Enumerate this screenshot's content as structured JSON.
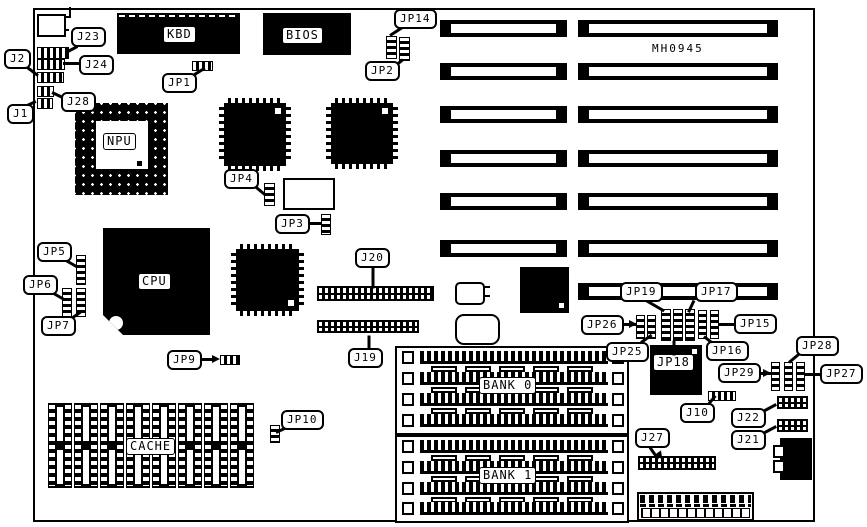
{
  "diagram": {
    "title": "Motherboard jumper and connector location diagram",
    "model": "MH0945",
    "ink": "#000000",
    "paper": "#ffffff"
  },
  "chips": {
    "kbd": "KBD",
    "bios": "BIOS",
    "npu": "NPU",
    "cpu": "CPU",
    "jp18": "JP18"
  },
  "memory": {
    "cache": "CACHE",
    "bank0": "BANK 0",
    "bank1": "BANK 1"
  },
  "callouts": {
    "j1": "J1",
    "j2": "J2",
    "j10": "J10",
    "j19": "J19",
    "j20": "J20",
    "j21": "J21",
    "j22": "J22",
    "j23": "J23",
    "j24": "J24",
    "j27": "J27",
    "j28": "J28",
    "jp1": "JP1",
    "jp2": "JP2",
    "jp3": "JP3",
    "jp4": "JP4",
    "jp5": "JP5",
    "jp6": "JP6",
    "jp7": "JP7",
    "jp9": "JP9",
    "jp10": "JP10",
    "jp14": "JP14",
    "jp15": "JP15",
    "jp16": "JP16",
    "jp17": "JP17",
    "jp19": "JP19",
    "jp25": "JP25",
    "jp26": "JP26",
    "jp27": "JP27",
    "jp28": "JP28",
    "jp29": "JP29"
  }
}
